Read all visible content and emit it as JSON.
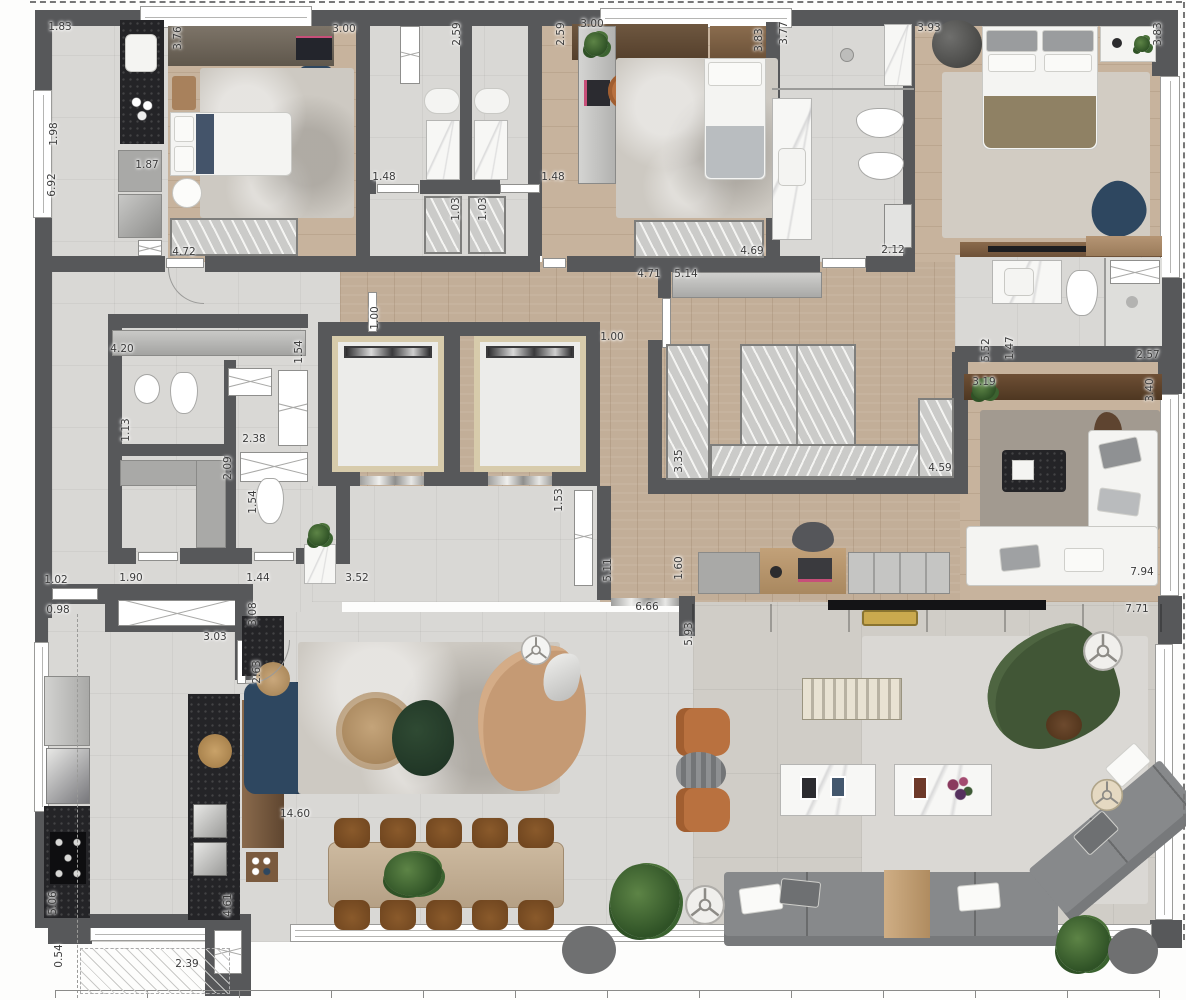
{
  "plan": {
    "type": "apartment-floor-plan",
    "colors": {
      "wall": "#57585a",
      "wood_floor": "#c2ae98",
      "tile_floor": "#d9d8d5",
      "terrace_floor": "#d0cdc7",
      "counter_black": "#242427",
      "tv_wall_brown": "#5c4531",
      "sofa_tan": "#c59a74",
      "sofa_green": "#415636",
      "sofa_navy": "#2e4760",
      "armchair_orange": "#b9713f",
      "sectional_gray": "#87898b"
    },
    "dimension_unit": "m"
  },
  "dimension_labels": [
    {
      "t": "1.83",
      "x": 60,
      "y": 27,
      "r": 0
    },
    {
      "t": "3.76",
      "x": 178,
      "y": 38,
      "r": 1
    },
    {
      "t": "3.00",
      "x": 344,
      "y": 29,
      "r": 0
    },
    {
      "t": "2.59",
      "x": 457,
      "y": 34,
      "r": 1
    },
    {
      "t": "2.59",
      "x": 561,
      "y": 34,
      "r": 1
    },
    {
      "t": "3.00",
      "x": 592,
      "y": 24,
      "r": 0
    },
    {
      "t": "3.83",
      "x": 759,
      "y": 40,
      "r": 1
    },
    {
      "t": "3.77",
      "x": 784,
      "y": 33,
      "r": 1
    },
    {
      "t": "3.93",
      "x": 929,
      "y": 28,
      "r": 0
    },
    {
      "t": "3.83",
      "x": 1158,
      "y": 34,
      "r": 1
    },
    {
      "t": "1.98",
      "x": 54,
      "y": 134,
      "r": 1
    },
    {
      "t": "6.92",
      "x": 52,
      "y": 185,
      "r": 1
    },
    {
      "t": "1.87",
      "x": 147,
      "y": 165,
      "r": 0
    },
    {
      "t": "1.48",
      "x": 384,
      "y": 177,
      "r": 0
    },
    {
      "t": "1.48",
      "x": 553,
      "y": 177,
      "r": 0
    },
    {
      "t": "1.03",
      "x": 456,
      "y": 209,
      "r": 1
    },
    {
      "t": "1.03",
      "x": 483,
      "y": 209,
      "r": 1
    },
    {
      "t": "4.72",
      "x": 184,
      "y": 252,
      "r": 0
    },
    {
      "t": "4.69",
      "x": 752,
      "y": 251,
      "r": 0
    },
    {
      "t": "2.12",
      "x": 893,
      "y": 250,
      "r": 0
    },
    {
      "t": "4.71",
      "x": 649,
      "y": 274,
      "r": 0
    },
    {
      "t": "5.14",
      "x": 686,
      "y": 274,
      "r": 0
    },
    {
      "t": "1.00",
      "x": 375,
      "y": 318,
      "r": 1
    },
    {
      "t": "1.00",
      "x": 612,
      "y": 337,
      "r": 0
    },
    {
      "t": "4.20",
      "x": 122,
      "y": 349,
      "r": 0
    },
    {
      "t": "1.54",
      "x": 299,
      "y": 352,
      "r": 1
    },
    {
      "t": "1.13",
      "x": 126,
      "y": 430,
      "r": 1
    },
    {
      "t": "2.38",
      "x": 254,
      "y": 439,
      "r": 0
    },
    {
      "t": "2.09",
      "x": 228,
      "y": 468,
      "r": 1
    },
    {
      "t": "1.54",
      "x": 253,
      "y": 502,
      "r": 1
    },
    {
      "t": "3.35",
      "x": 679,
      "y": 461,
      "r": 1
    },
    {
      "t": "4.59",
      "x": 940,
      "y": 468,
      "r": 0
    },
    {
      "t": "3.19",
      "x": 984,
      "y": 382,
      "r": 0
    },
    {
      "t": "5.52",
      "x": 986,
      "y": 350,
      "r": 1
    },
    {
      "t": "1.47",
      "x": 1010,
      "y": 348,
      "r": 1
    },
    {
      "t": "2.57",
      "x": 1148,
      "y": 355,
      "r": 0
    },
    {
      "t": "3.40",
      "x": 1150,
      "y": 390,
      "r": 1
    },
    {
      "t": "1.53",
      "x": 559,
      "y": 500,
      "r": 1
    },
    {
      "t": "5.11",
      "x": 608,
      "y": 570,
      "r": 1
    },
    {
      "t": "1.60",
      "x": 679,
      "y": 568,
      "r": 1
    },
    {
      "t": "1.02",
      "x": 56,
      "y": 580,
      "r": 0
    },
    {
      "t": "1.90",
      "x": 131,
      "y": 578,
      "r": 0
    },
    {
      "t": "1.44",
      "x": 258,
      "y": 578,
      "r": 0
    },
    {
      "t": "3.52",
      "x": 357,
      "y": 578,
      "r": 0
    },
    {
      "t": "0.98",
      "x": 58,
      "y": 610,
      "r": 0
    },
    {
      "t": "3.08",
      "x": 253,
      "y": 614,
      "r": 1
    },
    {
      "t": "3.03",
      "x": 215,
      "y": 637,
      "r": 0
    },
    {
      "t": "6.66",
      "x": 647,
      "y": 607,
      "r": 0
    },
    {
      "t": "7.94",
      "x": 1142,
      "y": 572,
      "r": 0
    },
    {
      "t": "7.71",
      "x": 1137,
      "y": 609,
      "r": 0
    },
    {
      "t": "5.93",
      "x": 689,
      "y": 634,
      "r": 1
    },
    {
      "t": "2.63",
      "x": 257,
      "y": 672,
      "r": 1
    },
    {
      "t": "14.60",
      "x": 295,
      "y": 814,
      "r": 0
    },
    {
      "t": "5.06",
      "x": 53,
      "y": 903,
      "r": 1
    },
    {
      "t": "4.61",
      "x": 228,
      "y": 905,
      "r": 1
    },
    {
      "t": "0.54",
      "x": 59,
      "y": 956,
      "r": 1
    },
    {
      "t": "2.39",
      "x": 187,
      "y": 964,
      "r": 0
    }
  ]
}
